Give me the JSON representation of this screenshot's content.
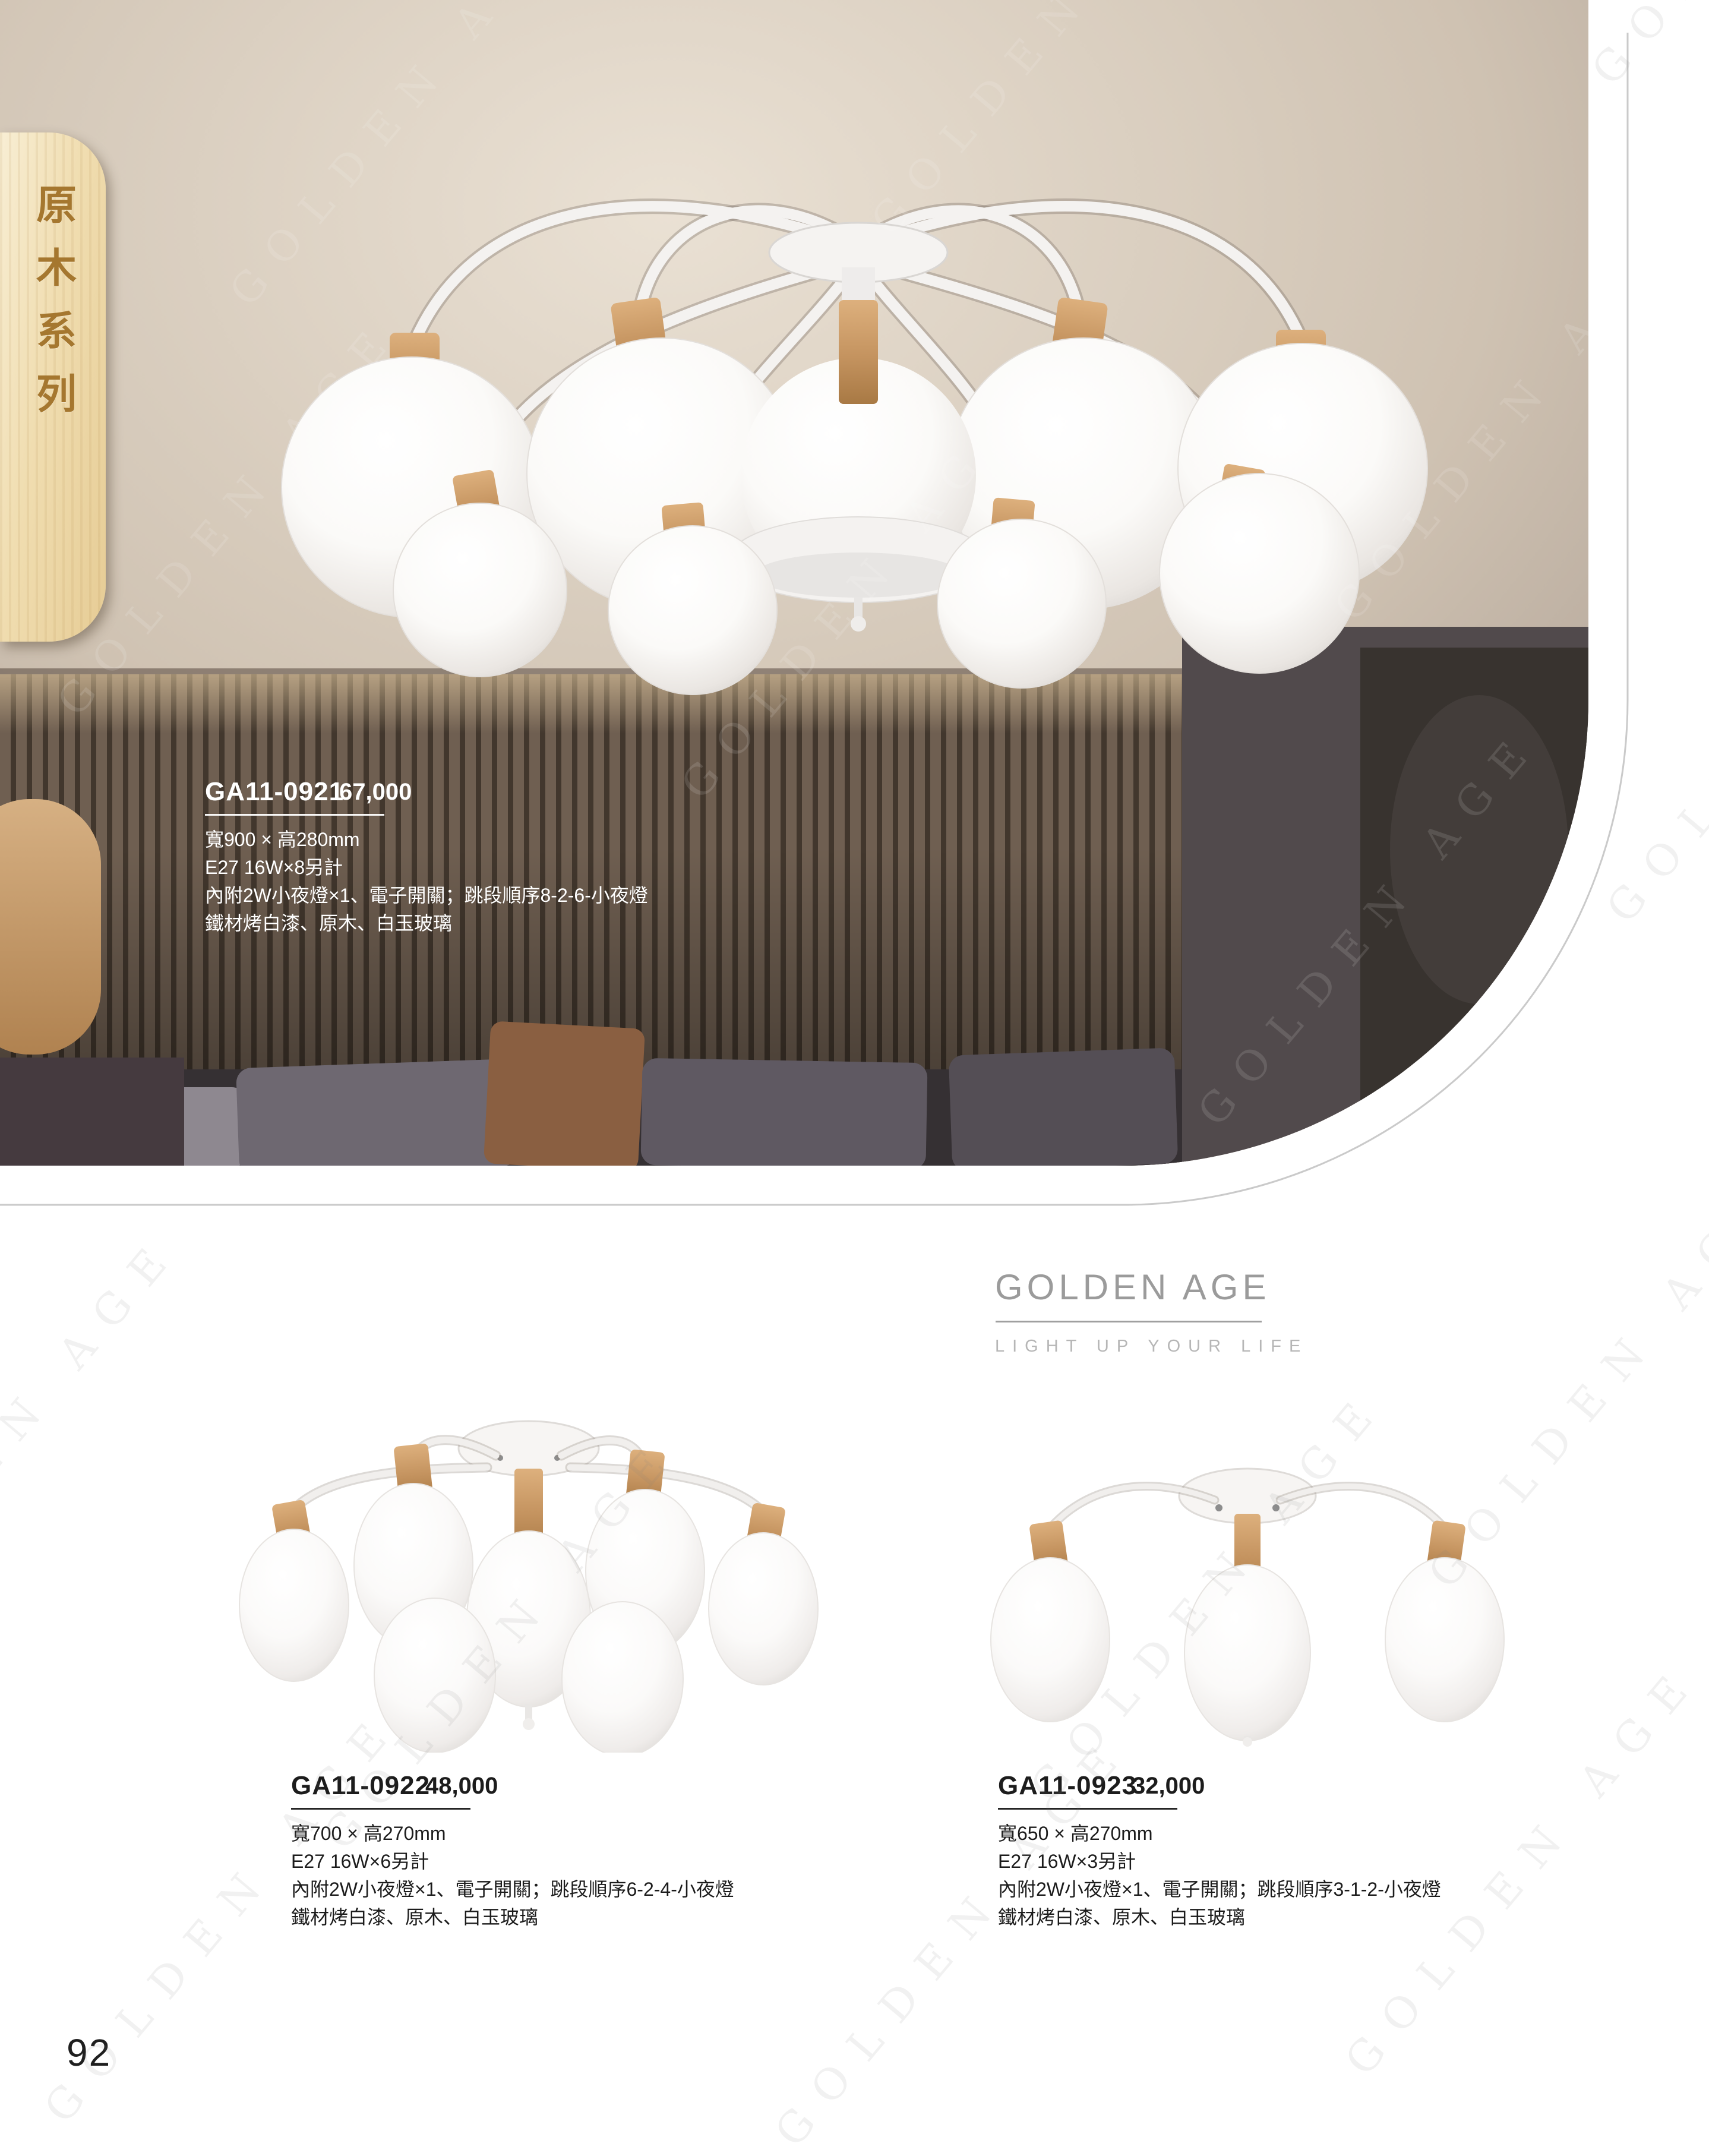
{
  "page": {
    "number": "92"
  },
  "series_tab": {
    "label": "原木系列"
  },
  "brand": {
    "name": "GOLDEN AGE",
    "tagline": "LIGHT UP YOUR LIFE",
    "watermark": "GOLDEN AGE"
  },
  "products": [
    {
      "model": "GA11-0921",
      "price": "67,000",
      "specs": [
        "寬900 × 高280mm",
        "E27 16W×8另計",
        "內附2W小夜燈×1、電子開關；跳段順序8-2-6-小夜燈",
        "鐵材烤白漆、原木、白玉玻璃"
      ]
    },
    {
      "model": "GA11-0922",
      "price": "48,000",
      "specs": [
        "寬700 × 高270mm",
        "E27 16W×6另計",
        "內附2W小夜燈×1、電子開關；跳段順序6-2-4-小夜燈",
        "鐵材烤白漆、原木、白玉玻璃"
      ]
    },
    {
      "model": "GA11-0923",
      "price": "32,000",
      "specs": [
        "寬650 × 高270mm",
        "E27 16W×3另計",
        "內附2W小夜燈×1、電子開關；跳段順序3-1-2-小夜燈",
        "鐵材烤白漆、原木、白玉玻璃"
      ]
    }
  ]
}
